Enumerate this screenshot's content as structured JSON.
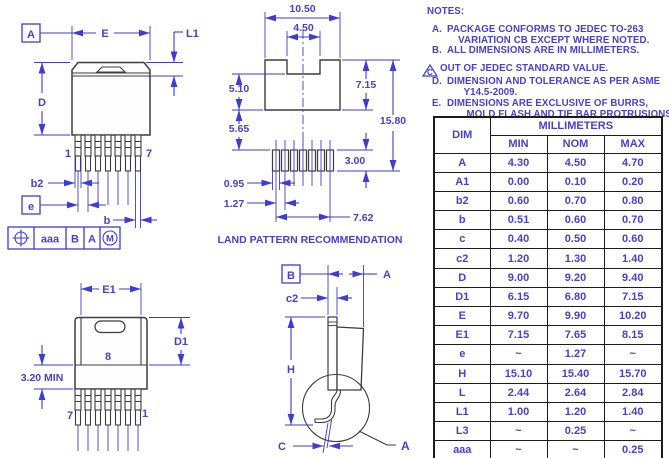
{
  "colors": {
    "dim_blue": "#3d3dd2",
    "text_blue": "#4742cb",
    "outline_dark": "#3d3d3d",
    "table_border": "#1c1c1c",
    "background": "#ffffff"
  },
  "front_view": {
    "datum_a": "A",
    "dim_e": "E",
    "dim_l1": "L1",
    "dim_d": "D",
    "pin_1": "1",
    "pin_7": "7",
    "dim_b2": "b2",
    "datum_e": "e",
    "dim_b": "b",
    "fcf_tolerance": "aaa",
    "fcf_datum_primary": "B",
    "fcf_datum_secondary": "A",
    "fcf_modifier": "M"
  },
  "land_pattern": {
    "title": "LAND PATTERN RECOMMENDATION",
    "dim_overall_width": "10.50",
    "dim_notch_width": "4.50",
    "dim_tab_lower": "5.10",
    "dim_tab_height": "7.15",
    "dim_gap": "5.65",
    "dim_overall_height": "15.80",
    "dim_pad_height": "3.00",
    "dim_pad_width": "0.95",
    "dim_pitch": "1.27",
    "dim_span": "7.62"
  },
  "back_view": {
    "dim_e1": "E1",
    "dim_d1": "D1",
    "dim_standoff": "3.20 MIN",
    "tab_pad": "8",
    "pin_7": "7",
    "pin_1": "1"
  },
  "side_view": {
    "datum_b": "B",
    "dim_a": "A",
    "dim_c2": "c2",
    "dim_h": "H",
    "dim_c": "C",
    "leader_a": "A"
  },
  "notes": {
    "title": "NOTES:",
    "items": [
      {
        "label": "A.",
        "flagged": false,
        "text": "PACKAGE CONFORMS TO JEDEC TO-263\n    VARIATION CB EXCEPT WHERE NOTED."
      },
      {
        "label": "B.",
        "flagged": false,
        "text": "ALL DIMENSIONS ARE IN MILLIMETERS."
      },
      {
        "label": "C",
        "flagged": true,
        "text": "OUT OF JEDEC STANDARD VALUE."
      },
      {
        "label": "D.",
        "flagged": false,
        "text": "DIMENSION AND TOLERANCE AS PER ASME\n      Y14.5-2009."
      },
      {
        "label": "E.",
        "flagged": false,
        "text": "DIMENSIONS ARE EXCLUSIVE OF BURRS,\n       MOLD FLASH AND TIE BAR PROTRUSIONS."
      }
    ]
  },
  "table": {
    "header_dim": "DIM",
    "header_units": "MILLIMETERS",
    "columns": [
      "MIN",
      "NOM",
      "MAX"
    ],
    "rows": [
      [
        "A",
        "4.30",
        "4.50",
        "4.70"
      ],
      [
        "A1",
        "0.00",
        "0.10",
        "0.20"
      ],
      [
        "b2",
        "0.60",
        "0.70",
        "0.80"
      ],
      [
        "b",
        "0.51",
        "0.60",
        "0.70"
      ],
      [
        "c",
        "0.40",
        "0.50",
        "0.60"
      ],
      [
        "c2",
        "1.20",
        "1.30",
        "1.40"
      ],
      [
        "D",
        "9.00",
        "9.20",
        "9.40"
      ],
      [
        "D1",
        "6.15",
        "6.80",
        "7.15"
      ],
      [
        "E",
        "9.70",
        "9.90",
        "10.20"
      ],
      [
        "E1",
        "7.15",
        "7.65",
        "8.15"
      ],
      [
        "e",
        "~",
        "1.27",
        "~"
      ],
      [
        "H",
        "15.10",
        "15.40",
        "15.70"
      ],
      [
        "L",
        "2.44",
        "2.64",
        "2.84"
      ],
      [
        "L1",
        "1.00",
        "1.20",
        "1.40"
      ],
      [
        "L3",
        "~",
        "0.25",
        "~"
      ],
      [
        "aaa",
        "~",
        "~",
        "0.25"
      ]
    ]
  }
}
